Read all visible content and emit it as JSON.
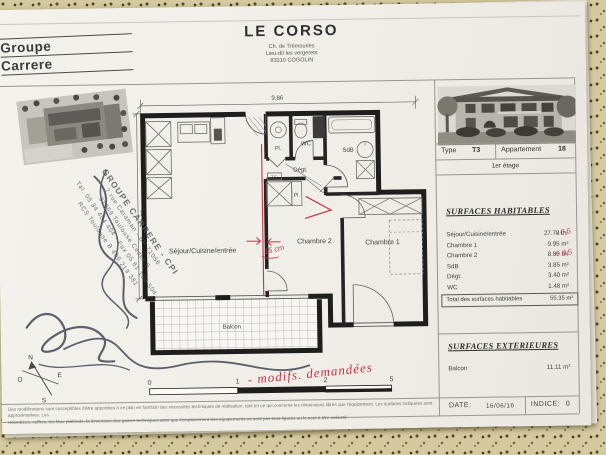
{
  "logo": {
    "line1": "Groupe",
    "line2": "Carrere"
  },
  "header": {
    "title": "LE CORSO",
    "address1": "Ch. de Trémouries",
    "address2": "Lieu-dit les vergerets",
    "address3": "83310 COGOLIN"
  },
  "info": {
    "type_label": "Type",
    "type_value": "T3",
    "apt_label": "Appartement",
    "apt_value": "18",
    "floor": "1er étage"
  },
  "surfaces_habitables": {
    "title": "SURFACES HABITABLES",
    "rows": [
      {
        "label": "Séjour/Cuisine/entrée",
        "value": "27.78 m²",
        "note": "- 0,5"
      },
      {
        "label": "Chambre 1",
        "value": "9.95 m²",
        "note": ""
      },
      {
        "label": "Chambre 2",
        "value": "8.89 m²",
        "note": "+ 0,5"
      },
      {
        "label": "SdB",
        "value": "3.85 m²",
        "note": ""
      },
      {
        "label": "Dégt.",
        "value": "3.40 m²",
        "note": ""
      },
      {
        "label": "WC",
        "value": "1.48 m²",
        "note": ""
      }
    ],
    "total_label": "Total des surfaces habitables",
    "total_value": "55.35 m²"
  },
  "surfaces_exterieures": {
    "title": "SURFACES EXTERIEURES",
    "row_label": "Balcon",
    "row_value": "11.11 m²"
  },
  "footer": {
    "date_label": "DATE:",
    "date_value": "16/06/16",
    "indice_label": "INDICE:",
    "indice_value": "0",
    "disclaimer1": "Des modifications sont susceptibles d'être apportées à ce plan en fonction des nécessités techniques de réalisation, tant en ce qui concerne les dimensions libres que l'équipement. Les surfaces indiquées sont approximatives. Les",
    "disclaimer2": "retombées, coffres, les faux-plafonds, la dimension des gaines techniques ainsi que l'emplacement des équipements ne sont pas tous figurés ou le sont à titre indicatif."
  },
  "plan": {
    "dim_width": "9.86",
    "dim_height": "4.23",
    "rooms": {
      "sejour": "Séjour/Cuisine/entrée",
      "chambre2": "Chambre 2",
      "chambre1": "Chambre 1",
      "wc": "WC",
      "sdb": "SdB",
      "degt": "Dégt.",
      "pl1": "Pl.",
      "pl2": "Pl.",
      "te": "T.E.",
      "balcon": "Balcon"
    },
    "scale_ticks": {
      "t0": "0",
      "t1": "1",
      "t2": "2",
      "t5": "5"
    },
    "compass": {
      "n": "N",
      "s": "S",
      "e": "E",
      "o": "O"
    }
  },
  "annotations": {
    "wall_shift": "15 cm",
    "modifs": "- modifs. demandées"
  },
  "stamp": {
    "l1": "GROUPE CARRERE - CPI",
    "l2": "7 rue Caraman - BP 71056",
    "l3": "31069 Toulouse Cedex 6",
    "l4": "Tél. 05 34 404 404 - Fax 05 61 130 504",
    "l5": "RCS Toulouse B 408 219 381"
  }
}
